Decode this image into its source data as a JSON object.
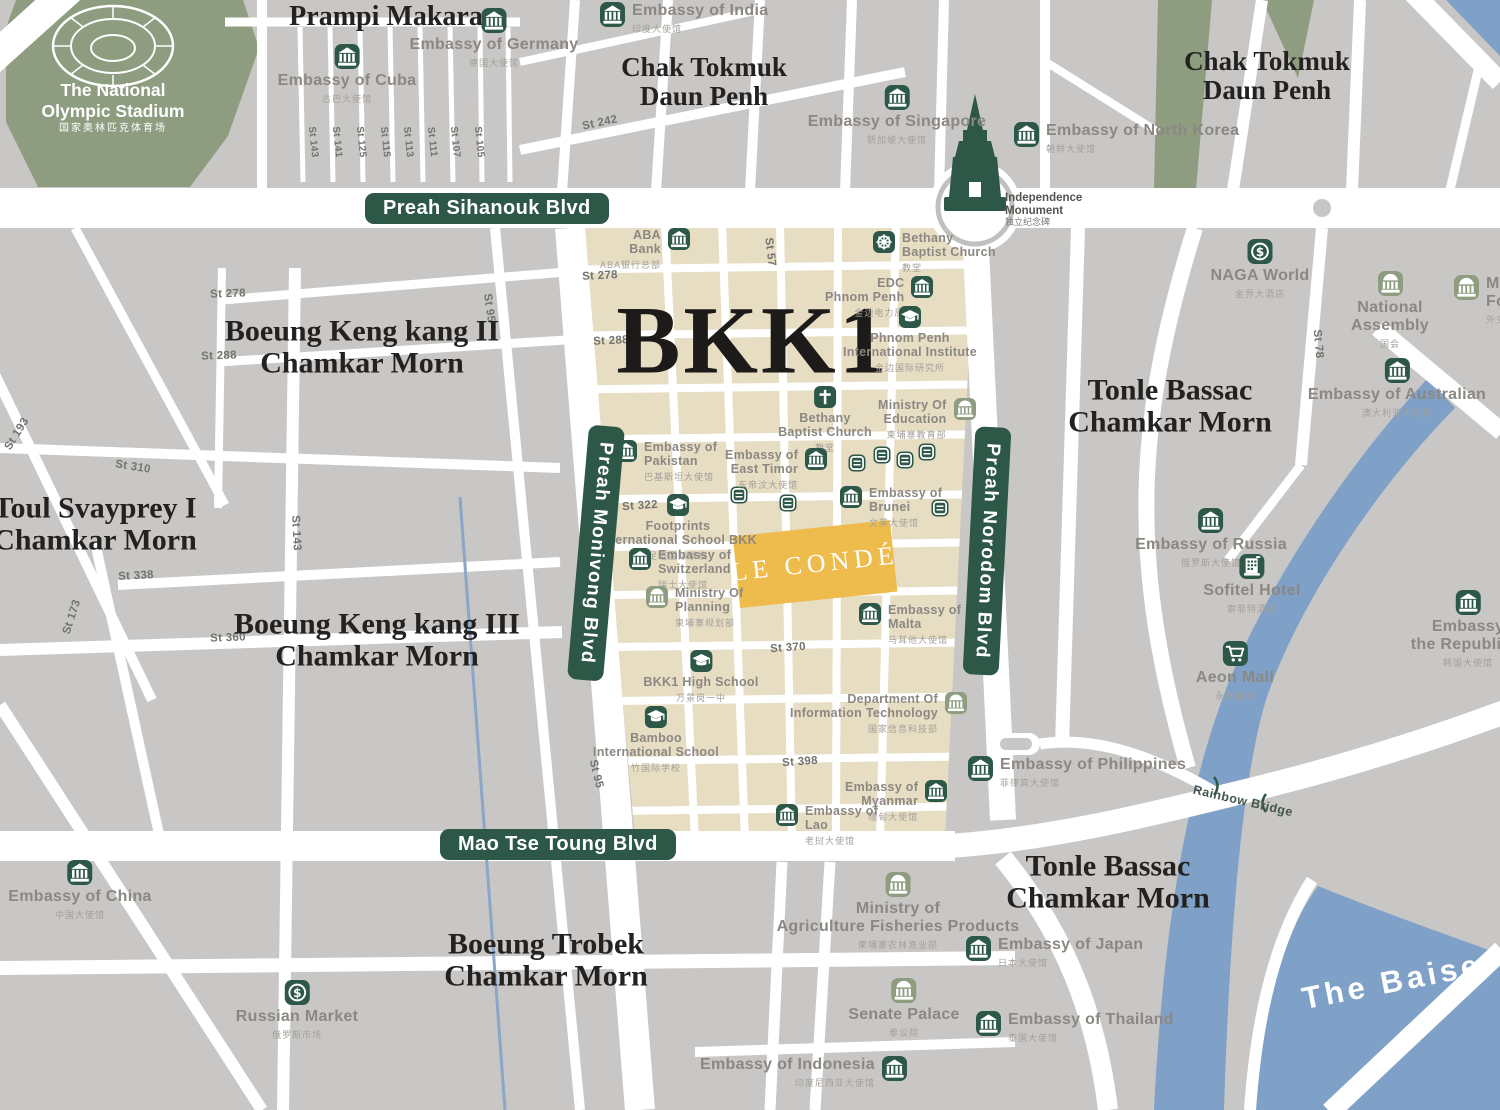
{
  "colors": {
    "accent_green": "#2d5847",
    "sage_green": "#8e9d7f",
    "district_beige": "#e7ddc3",
    "water_blue": "#7fa1c7",
    "highlight_yellow": "#eebb4d",
    "block_gray": "#c9c7c5"
  },
  "title_area": {
    "bkk1": "BKK1",
    "le_conde": "LE CONDÉ"
  },
  "stadium": {
    "line1": "The National",
    "line2": "Olympic Stadium",
    "zh": "国家奥林匹克体育场"
  },
  "monument": {
    "line1": "Independence",
    "line2": "Monument",
    "zh": "独立纪念碑"
  },
  "river": {
    "name": "The Baise",
    "bridge": "Rainbow Bridge"
  },
  "boulevards": {
    "sihanouk": "Preah Sihanouk Blvd",
    "mao": "Mao Tse Toung Blvd",
    "monivong": "Preah Monivong Blvd",
    "norodom": "Preah Norodom Blvd"
  },
  "districts": [
    {
      "l1": "Prampi Makara",
      "l2": ""
    },
    {
      "l1": "Chak Tokmuk",
      "l2": "Daun Penh"
    },
    {
      "l1": "Chak Tokmuk",
      "l2": "Daun Penh"
    },
    {
      "l1": "Boeung Keng kang II",
      "l2": "Chamkar Morn"
    },
    {
      "l1": "Toul Svayprey I",
      "l2": "Chamkar Morn"
    },
    {
      "l1": "Boeung Keng kang III",
      "l2": "Chamkar Morn"
    },
    {
      "l1": "Tonle Bassac",
      "l2": "Chamkar Morn"
    },
    {
      "l1": "Tonle Bassac",
      "l2": "Chamkar Morn"
    },
    {
      "l1": "Boeung Trobek",
      "l2": "Chamkar Morn"
    }
  ],
  "streets": [
    "St 143",
    "St 141",
    "St 125",
    "St 115",
    "St 113",
    "St 111",
    "St 107",
    "St 105",
    "St 242",
    "St 278",
    "St 278",
    "St 288",
    "St 288",
    "St 57",
    "St 310",
    "St 322",
    "St 338",
    "St 360",
    "St 370",
    "St 398",
    "St 95",
    "St 95",
    "St 143",
    "St 173",
    "St 193",
    "St 78"
  ],
  "pois": [
    {
      "l1": "Embassy of Cuba",
      "zh": "古巴大使馆"
    },
    {
      "l1": "Embassy of Germany",
      "zh": "德国大使馆"
    },
    {
      "l1": "Embassy of India",
      "zh": "印度大使馆"
    },
    {
      "l1": "Embassy of Singapore",
      "zh": "新加坡大使馆"
    },
    {
      "l1": "Embassy of North Korea",
      "zh": "朝鲜大使馆"
    },
    {
      "l1": "ABA",
      "l2": "Bank",
      "zh": "ABA银行总部"
    },
    {
      "l1": "Bethany",
      "l2": "Baptist Church",
      "zh": "教堂"
    },
    {
      "l1": "EDC",
      "l2": "Phnom Penh",
      "zh": "金边电力局"
    },
    {
      "l1": "Phnom Penh",
      "l2": "International Institute",
      "zh": "金边国际研究所"
    },
    {
      "l1": "Bethany",
      "l2": "Baptist Church",
      "zh": "教堂"
    },
    {
      "l1": "Ministry Of",
      "l2": "Education",
      "zh": "柬埔寨教育部"
    },
    {
      "l1": "Embassy of",
      "l2": "Pakistan",
      "zh": "巴基斯坦大使馆"
    },
    {
      "l1": "Embassy of",
      "l2": "East Timor",
      "zh": "东帝汶大使馆"
    },
    {
      "l1": "Embassy of",
      "l2": "Brunei",
      "zh": "文莱大使馆"
    },
    {
      "l1": "Footprints",
      "l2": "International School BKK",
      "zh": "足迹国际学校"
    },
    {
      "l1": "Embassy of",
      "l2": "Switzerland",
      "zh": "瑞士大使馆"
    },
    {
      "l1": "Ministry Of",
      "l2": "Planning",
      "zh": "柬埔寨规划部"
    },
    {
      "l1": "Embassy of",
      "l2": "Malta",
      "zh": "马耳他大使馆"
    },
    {
      "l1": "BKK1 High School",
      "zh": "万景岗一中"
    },
    {
      "l1": "Bamboo",
      "l2": "International School",
      "zh": "竹国际学校"
    },
    {
      "l1": "Department Of",
      "l2": "Information Technology",
      "zh": "国家信息科技部"
    },
    {
      "l1": "Embassy of",
      "l2": "Myanmar",
      "zh": "缅甸大使馆"
    },
    {
      "l1": "Embassy of",
      "l2": "Lao",
      "zh": "老挝大使馆"
    },
    {
      "l1": "Embassy of Philippines",
      "zh": "菲律宾大使馆"
    },
    {
      "l1": "NAGA World",
      "zh": "金界大酒店"
    },
    {
      "l1": "National",
      "l2": "Assembly",
      "zh": "国会"
    },
    {
      "l1": "Mi",
      "l2": "Fo",
      "zh": "外交"
    },
    {
      "l1": "Embassy of Australian",
      "zh": "澳大利亚大使馆"
    },
    {
      "l1": "Embassy of Russia",
      "zh": "俄罗斯大使馆"
    },
    {
      "l1": "Sofitel Hotel",
      "zh": "索菲特酒店"
    },
    {
      "l1": "Aeon Mall",
      "zh": "永旺商场"
    },
    {
      "l1": "Embassy",
      "l2": "the Republic o",
      "zh": "韩国大使馆"
    },
    {
      "l1": "Embassy of China",
      "zh": "中国大使馆"
    },
    {
      "l1": "Russian Market",
      "zh": "俄罗斯市场"
    },
    {
      "l1": "Ministry of",
      "l2": "Agriculture Fisheries Products",
      "zh": "柬埔寨农林渔业部"
    },
    {
      "l1": "Senate Palace",
      "zh": "参议院"
    },
    {
      "l1": "Embassy of Indonesia",
      "zh": "印度尼西亚大使馆"
    },
    {
      "l1": "Embassy of Japan",
      "zh": "日本大使馆"
    },
    {
      "l1": "Embassy of Thailand",
      "zh": "泰国大使馆"
    }
  ]
}
